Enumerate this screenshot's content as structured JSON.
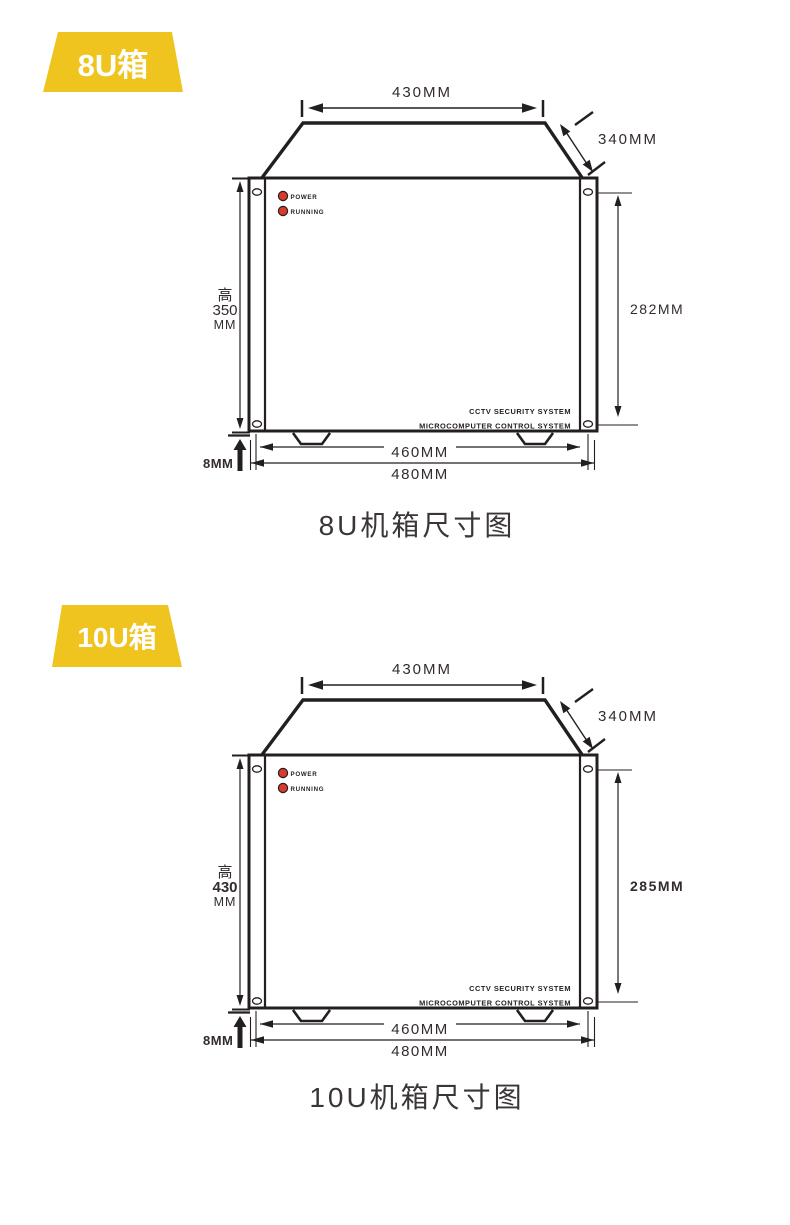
{
  "colors": {
    "badge_yellow": "#EFC41F",
    "led_red": "#D93A2B",
    "line_black": "#231F20",
    "dim_text": "#332B2C"
  },
  "s1": {
    "badge": "8U箱",
    "caption": "8U机箱尺寸图",
    "dims": {
      "top_width": "430MM",
      "depth": "340MM",
      "height_label": "高",
      "height_value": "350",
      "height_unit": "MM",
      "right_height": "282MM",
      "foot_height": "8MM",
      "inner_width": "460MM",
      "outer_width": "480MM"
    },
    "panel": {
      "led1": "POWER",
      "led2": "RUNNING",
      "brand_line1": "CCTV SECURITY SYSTEM",
      "brand_line2": "MICROCOMPUTER CONTROL SYSTEM"
    }
  },
  "s2": {
    "badge": "10U箱",
    "caption": "10U机箱尺寸图",
    "dims": {
      "top_width": "430MM",
      "depth": "340MM",
      "height_label": "高",
      "height_value": "430",
      "height_unit": "MM",
      "right_height": "285MM",
      "foot_height": "8MM",
      "inner_width": "460MM",
      "outer_width": "480MM"
    },
    "panel": {
      "led1": "POWER",
      "led2": "RUNNING",
      "brand_line1": "CCTV SECURITY SYSTEM",
      "brand_line2": "MICROCOMPUTER CONTROL SYSTEM"
    }
  }
}
